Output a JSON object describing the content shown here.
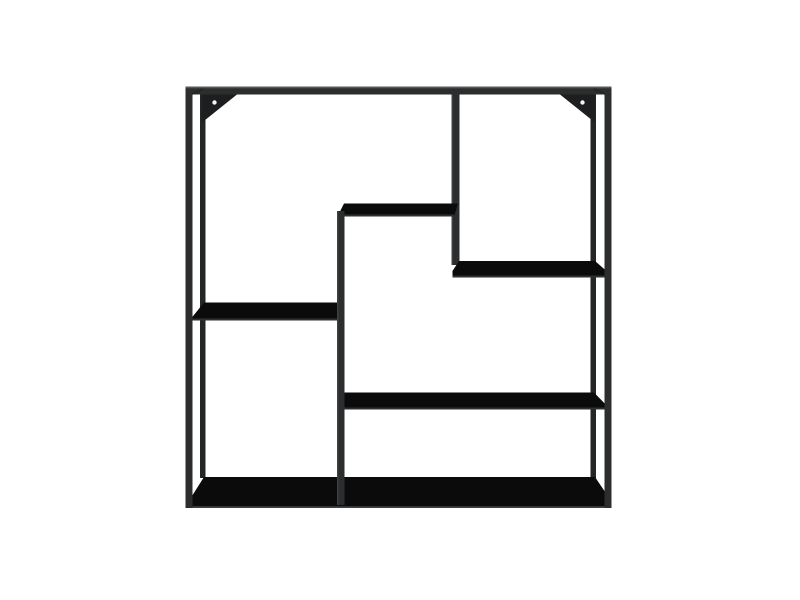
{
  "product": {
    "name": "Black square metal wall shelf",
    "description": "Square matte-black metal wall-mounted shelf with asymmetric open compartments, five shelf panels, a stepped centre divider, a right-hand divider and two triangular wall-mount brackets with screw holes",
    "color": "matte black",
    "shape": "square",
    "shelf_count": 5,
    "bracket_count": 2,
    "screw_hole_count": 2
  },
  "colors": {
    "background": "#ffffff",
    "frame": "#2b2d2e",
    "frame_dark": "#242526",
    "frame_highlight": "#55585a",
    "edge_highlight": "#3e4143",
    "shelf_surface": "#0b0b0c",
    "shelf_lip": "#2e3031",
    "bracket": "#1d1e1f",
    "screw_hole": "#f4f4f4"
  }
}
